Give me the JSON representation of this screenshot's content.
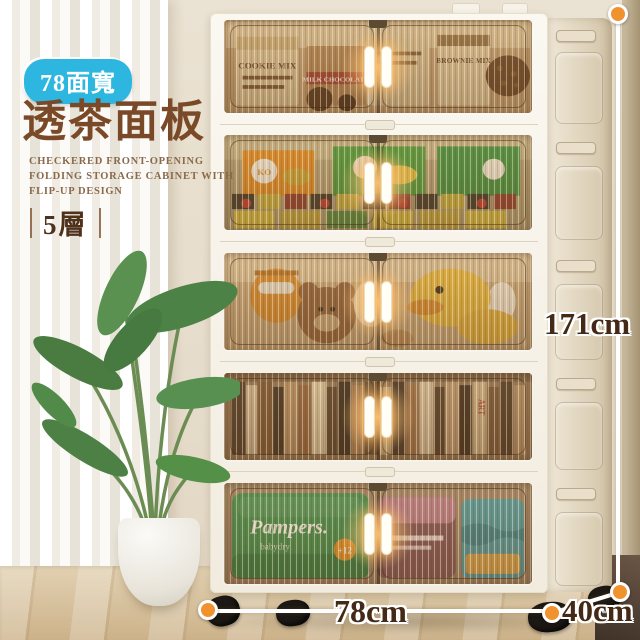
{
  "badge": {
    "label": "78面寬",
    "bg_color": "#2db7e0",
    "text_color": "#ffffff"
  },
  "title": {
    "text": "透茶面板",
    "color": "#7a4a28"
  },
  "subtitle": {
    "lines": [
      "CHECKERED FRONT-OPENING",
      "FOLDING STORAGE CABINET WITH",
      "FLIP-UP DESIGN"
    ],
    "color": "#8a6a4a"
  },
  "layers": {
    "label": "5層"
  },
  "dimensions": {
    "height": "171cm",
    "width": "78cm",
    "depth": "40cm",
    "line_color": "#ffffff",
    "dot_color": "#f0922e",
    "text_color": "#442a16"
  },
  "cabinet": {
    "frame_color": "#f8f4ec",
    "glass_tint": "#b98f5e",
    "handle_color": "#fffef7",
    "tier_count": 5,
    "tiers": [
      {
        "name": "baking-mixes",
        "texts": [
          "COOKIE MIX",
          "BROWNIE MIX",
          "MILK CHOCOLATE"
        ]
      },
      {
        "name": "snack-boxes",
        "texts": [
          "KO"
        ]
      },
      {
        "name": "plush-toys",
        "texts": []
      },
      {
        "name": "books",
        "texts": [
          "ART"
        ]
      },
      {
        "name": "diaper-packs",
        "texts": [
          "Pampers.",
          "babydry",
          "+12"
        ]
      }
    ]
  },
  "scene": {
    "wall_color": "#e7dfd0",
    "curtain_color": "#f7f4ef",
    "floor_color": "#d6bf9c",
    "plant": "potted-palm"
  }
}
